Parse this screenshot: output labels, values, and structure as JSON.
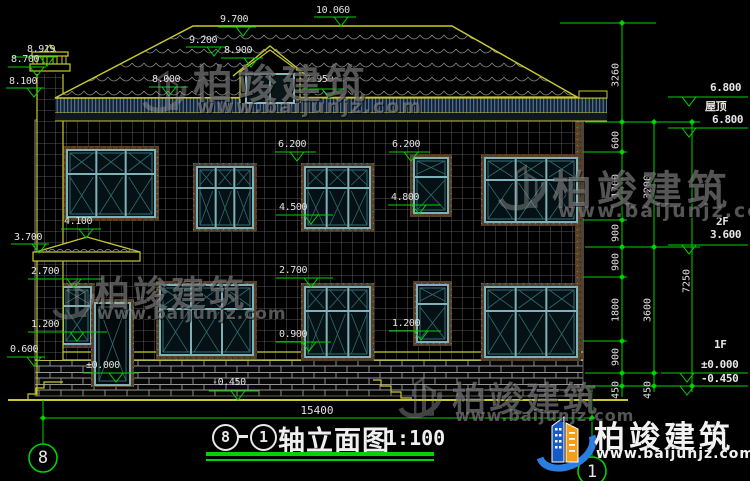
{
  "watermarks": {
    "brand": "柏竣建筑",
    "url": "www.baijunjz.com"
  },
  "brand_logo": {
    "name": "柏竣建筑",
    "url": "www.baijunjz.com"
  },
  "title_block": {
    "axis_from": "8",
    "axis_to": "1",
    "title": "轴立面图",
    "scale": "1:100"
  },
  "axis_bubbles": {
    "left": "8",
    "right": "1"
  },
  "bottom_dimension": {
    "total_width": "15400"
  },
  "level_labels": {
    "left": [
      "8.919",
      "8.700",
      "8.100",
      "3.700",
      "2.700",
      "1.200",
      "0.600"
    ],
    "inner": [
      "9.700",
      "10.060",
      "9.200",
      "8.900",
      "8.000",
      "7.950",
      "6.200",
      "6.200",
      "4.100",
      "4.500",
      "4.800",
      "2.700",
      "0.900",
      "1.200",
      "±0.000",
      "-0.450"
    ],
    "right": [
      "6.800",
      "屋顶",
      "6.800",
      "2F",
      "3.600",
      "1F",
      "±0.000",
      "-0.450"
    ]
  },
  "dimension_chains": {
    "roof": [
      "3260"
    ],
    "segments": [
      "600",
      "1700",
      "900",
      "900",
      "1800",
      "900",
      "450"
    ],
    "storeys": [
      "3200",
      "3600",
      "450"
    ],
    "total": [
      "7250"
    ]
  }
}
